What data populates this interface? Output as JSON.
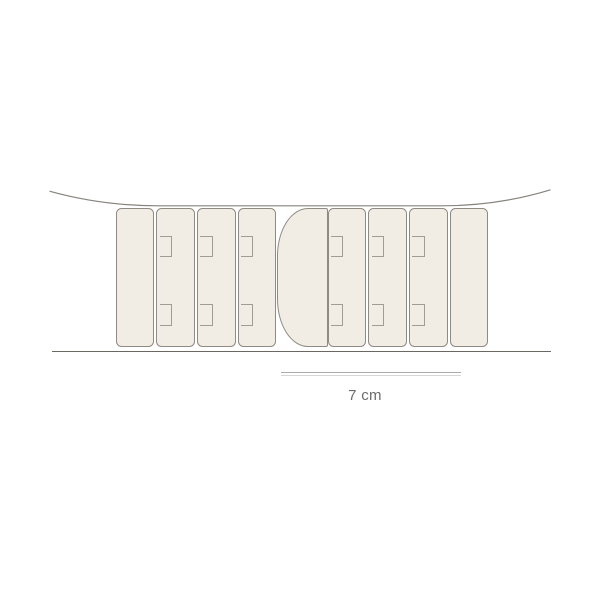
{
  "figure": {
    "type": "technical-illustration",
    "description": "Row of slats with hook notches hanging on a sagging wire above a base line, with a metric scale bar",
    "colors": {
      "background": "#ffffff",
      "slat_fill": "#f2ede4",
      "slat_stroke": "#8f8a83",
      "hook_stroke": "#a29c93",
      "wire_stroke": "#87837d",
      "baseline_stroke": "#6b6862",
      "scalebar_top": "#ababab",
      "scalebar_bottom": "#d6d6d6",
      "label_color": "#6c6c6c"
    },
    "wire": {
      "path": "M 49.5 191.2 Q 102 205.8 158 205.8 L 442 205.8 Q 498 205.8 550.5 189.8"
    },
    "slat_geometry": {
      "y": 207.7,
      "width": 38.8,
      "height": 139,
      "corner_radius": 5.5
    },
    "hook_geometry": {
      "offset_x": 2.3,
      "width": 12.5,
      "top_notch_y": 27.5,
      "top_notch_height": 21,
      "bottom_notch_y": 95,
      "bottom_notch_height": 22.5
    },
    "slats": [
      {
        "x": 115.7,
        "hooks": false
      },
      {
        "x": 156.4,
        "hooks": true
      },
      {
        "x": 197.0,
        "hooks": true
      },
      {
        "x": 237.6,
        "hooks": true
      },
      {
        "x": 327.7,
        "hooks": true
      },
      {
        "x": 368.3,
        "hooks": true
      },
      {
        "x": 408.9,
        "hooks": true
      },
      {
        "x": 449.5,
        "hooks": false
      }
    ],
    "connector": {
      "x": 277,
      "y": 207.7,
      "width": 50.5,
      "height": 139.3
    },
    "baseline": {
      "x": 52,
      "y": 350.8,
      "width": 499
    },
    "scalebar": {
      "x": 281,
      "y": 371.8,
      "width": 180
    },
    "scale": {
      "label": "7 cm",
      "label_x": 281,
      "label_y": 387,
      "label_width": 168
    }
  }
}
